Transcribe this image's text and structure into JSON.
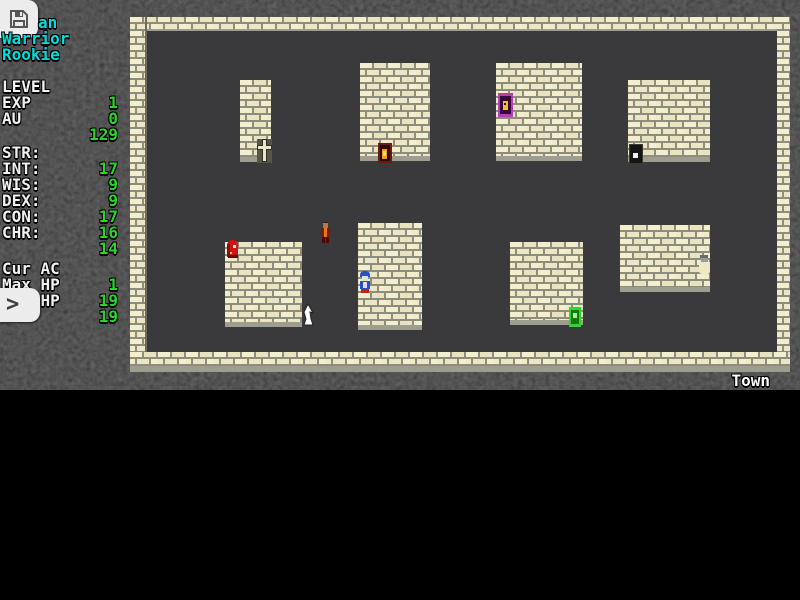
{
  "sidebar": {
    "character": {
      "name_visible": "an",
      "class_label": "Warrior",
      "rank_label": "Rookie"
    },
    "progress": [
      {
        "label": "LEVEL",
        "value": "1"
      },
      {
        "label": "EXP",
        "value": "0"
      },
      {
        "label": "AU",
        "value": "129"
      }
    ],
    "attributes": [
      {
        "label": "STR:",
        "value": "17"
      },
      {
        "label": "INT:",
        "value": "9"
      },
      {
        "label": "WIS:",
        "value": "9"
      },
      {
        "label": "DEX:",
        "value": "17"
      },
      {
        "label": "CON:",
        "value": "16"
      },
      {
        "label": "CHR:",
        "value": "14"
      }
    ],
    "vitals": [
      {
        "label": "Cur AC",
        "value": "1"
      },
      {
        "label": "Max HP",
        "value": "19"
      },
      {
        "label": "Cur HP",
        "value": "19"
      }
    ],
    "expand_button_glyph": ">"
  },
  "map": {
    "location_label": "Town",
    "entities": [
      "cross-shrine",
      "red-door-with-flame",
      "purple-door-with-figure",
      "black-door",
      "green-door",
      "robed-npc",
      "red-cloaked-npc",
      "player-character-blue",
      "white-townsperson",
      "cursor-arrow"
    ]
  },
  "icons": {
    "save": "floppy-disk-icon",
    "expand": "chevron-right-icon"
  },
  "colors": {
    "name_cyan": "#00dede",
    "label_white": "#f2f2f2",
    "value_green": "#2bd32b",
    "brick": "#f2edcb",
    "mortar": "#8d8d7e",
    "floor": "#3a3a3c",
    "background": "#000000"
  }
}
